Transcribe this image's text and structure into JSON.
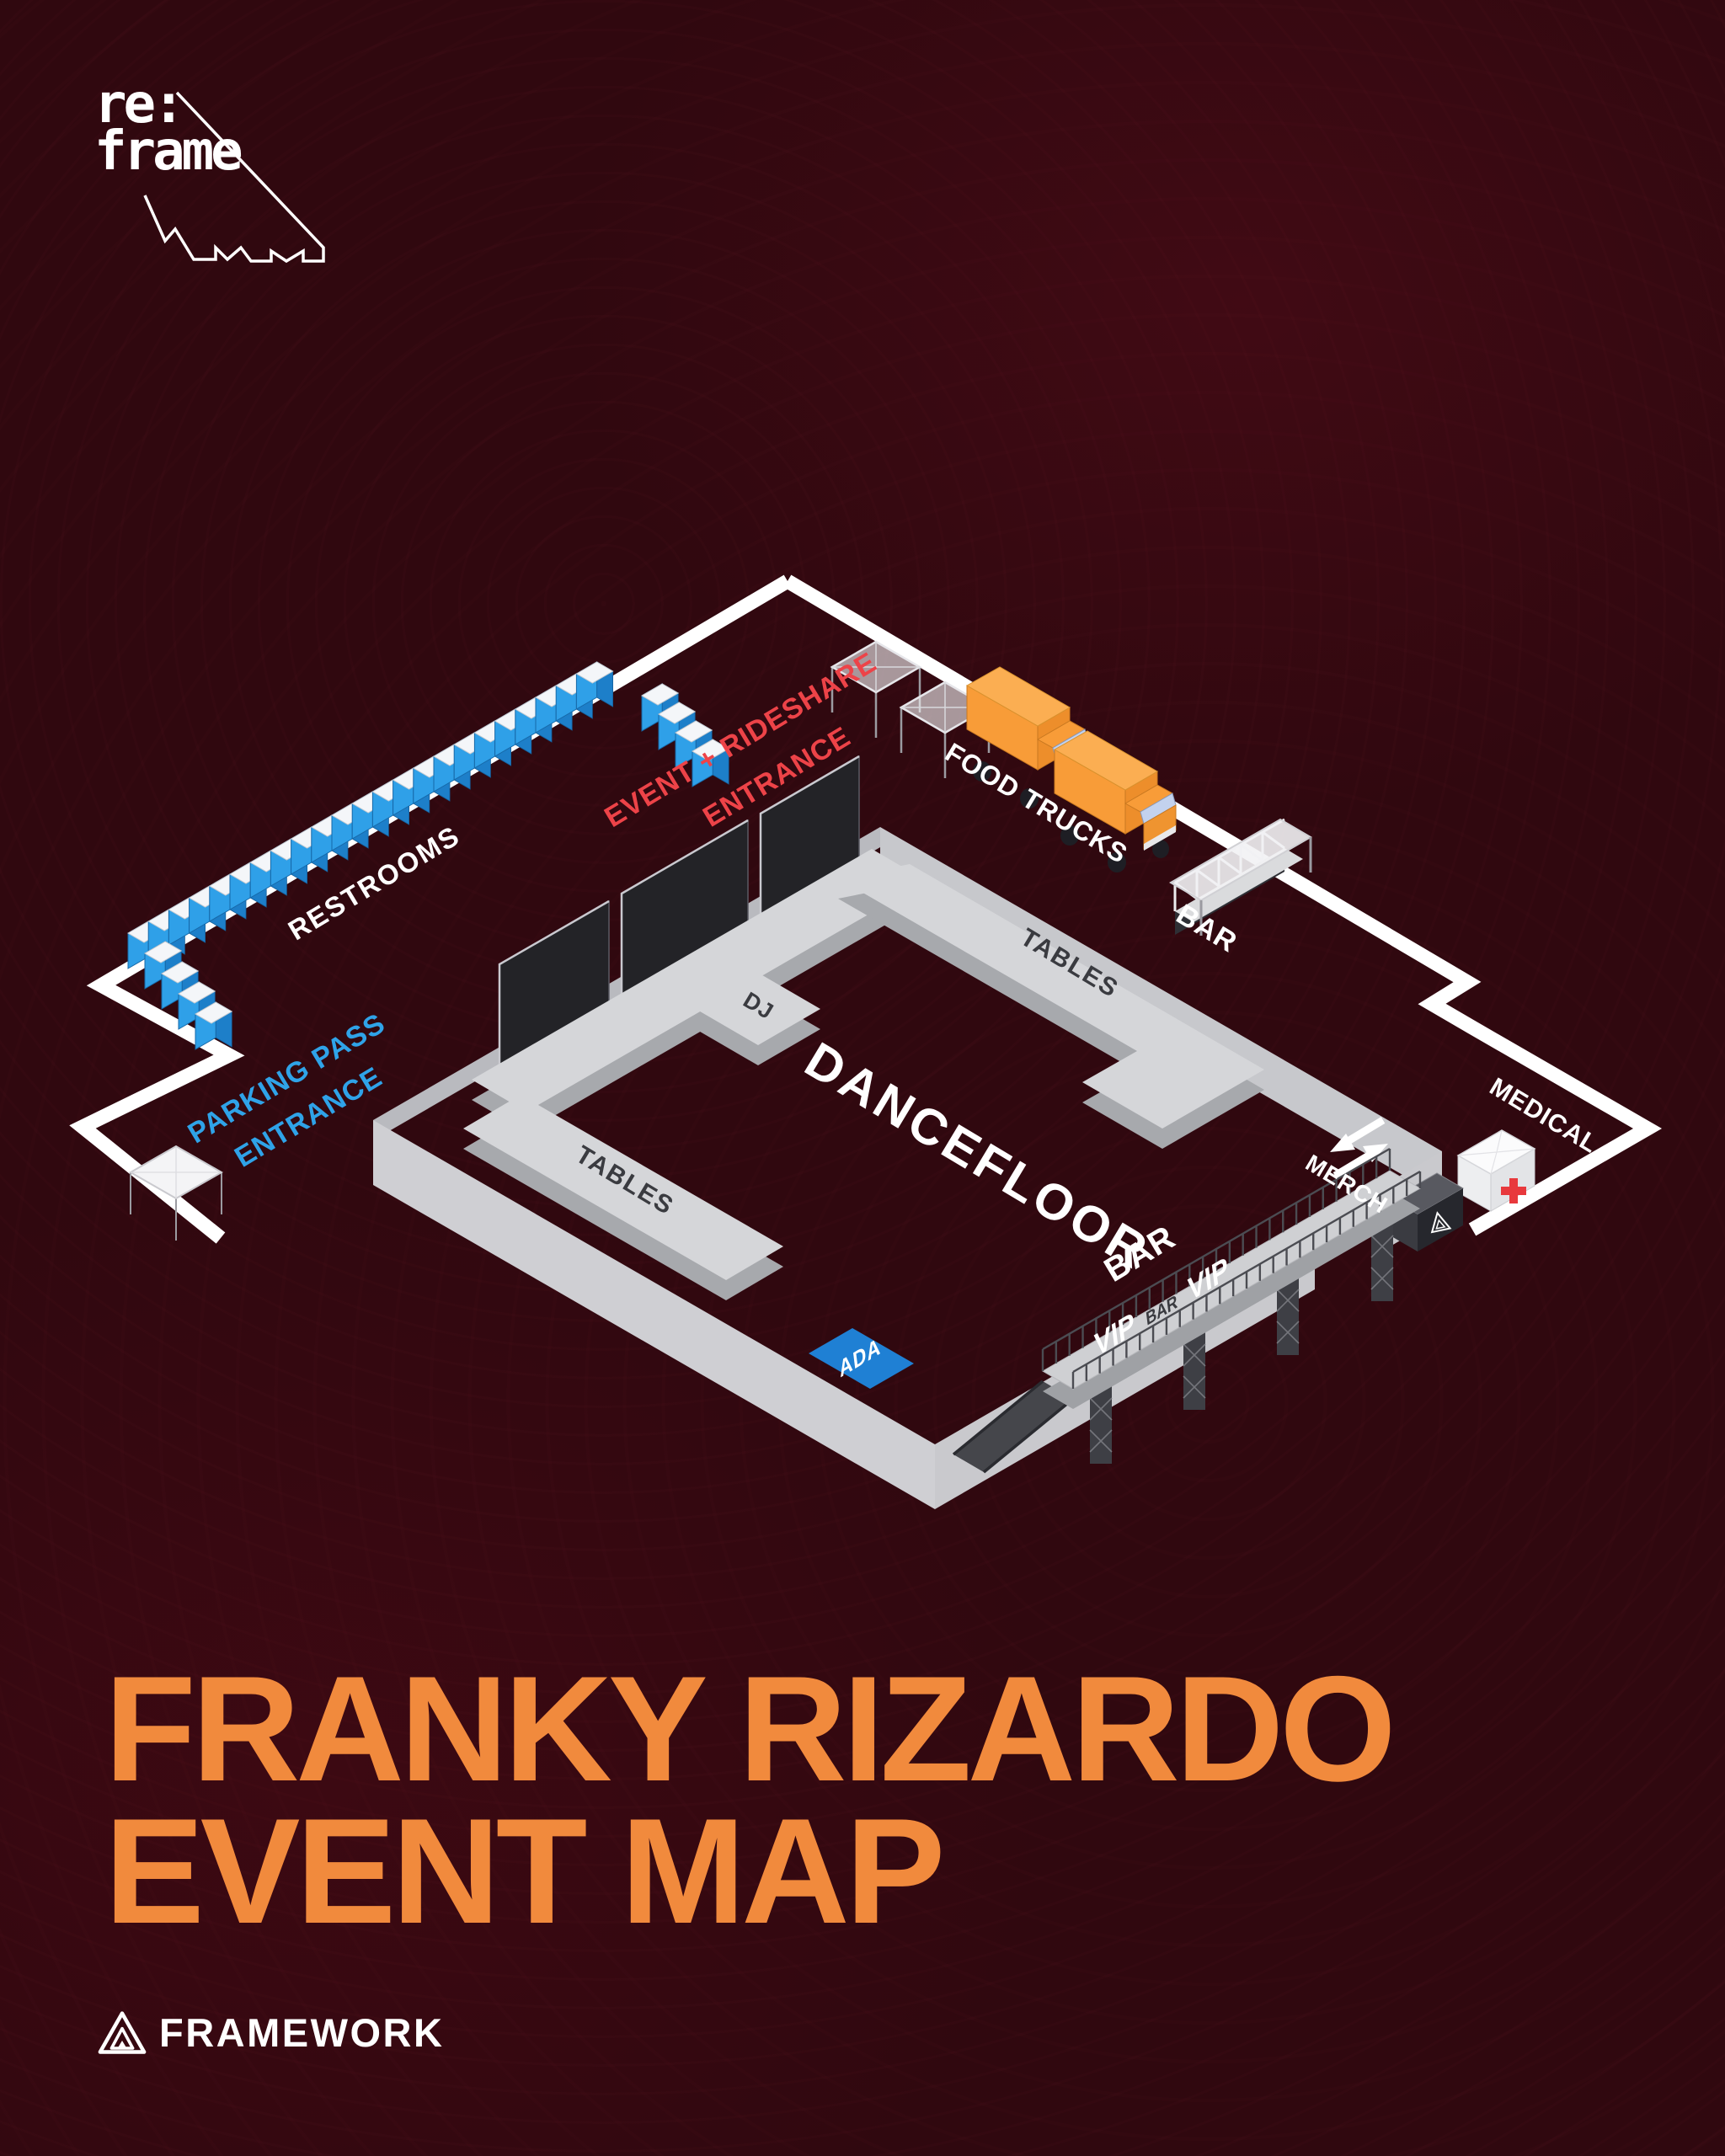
{
  "poster": {
    "background_color": "#30080F",
    "brand_logo": {
      "line1": "re:",
      "line2": "frame"
    },
    "title": {
      "line1": "FRANKY RIZARDO",
      "line2": "EVENT MAP",
      "color": "#F18A3D"
    },
    "footer": {
      "brand_name": "FRAMEWORK"
    }
  },
  "map": {
    "areas": {
      "restrooms": "RESTROOMS",
      "event_rideshare_entrance_line1": "EVENT + RIDESHARE",
      "event_rideshare_entrance_line2": "ENTRANCE",
      "parking_pass_entrance_line1": "PARKING PASS",
      "parking_pass_entrance_line2": "ENTRANCE",
      "food_trucks": "FOOD TRUCKS",
      "bar_north": "BAR",
      "tables_north": "TABLES",
      "tables_south": "TABLES",
      "dj": "DJ",
      "dancefloor": "DANCEFLOOR",
      "medical": "MEDICAL",
      "merch": "MERCH",
      "bar_indoor": "BAR",
      "vip_front": "VIP",
      "vip_bar_deck": "BAR",
      "vip_rear": "VIP",
      "ada": "ADA"
    },
    "colors": {
      "path_white": "#FFFFFF",
      "entrance_red": "#ED4348",
      "entrance_blue": "#2FA3E8",
      "restroom_blue": "#2FA0E8",
      "ada_blue": "#1F80D4",
      "truck_orange": "#F9A03C",
      "platform_gray": "#D5D6D9",
      "wall_gray": "#C9C9CD",
      "stage_panel_dark": "#232327",
      "medical_cross_red": "#E8393D"
    },
    "icons": {
      "medical_cross": "+",
      "entry_exit_arrows": "in/out arrows",
      "merch_logo": "triangle",
      "framework_logo": "triangle"
    }
  }
}
